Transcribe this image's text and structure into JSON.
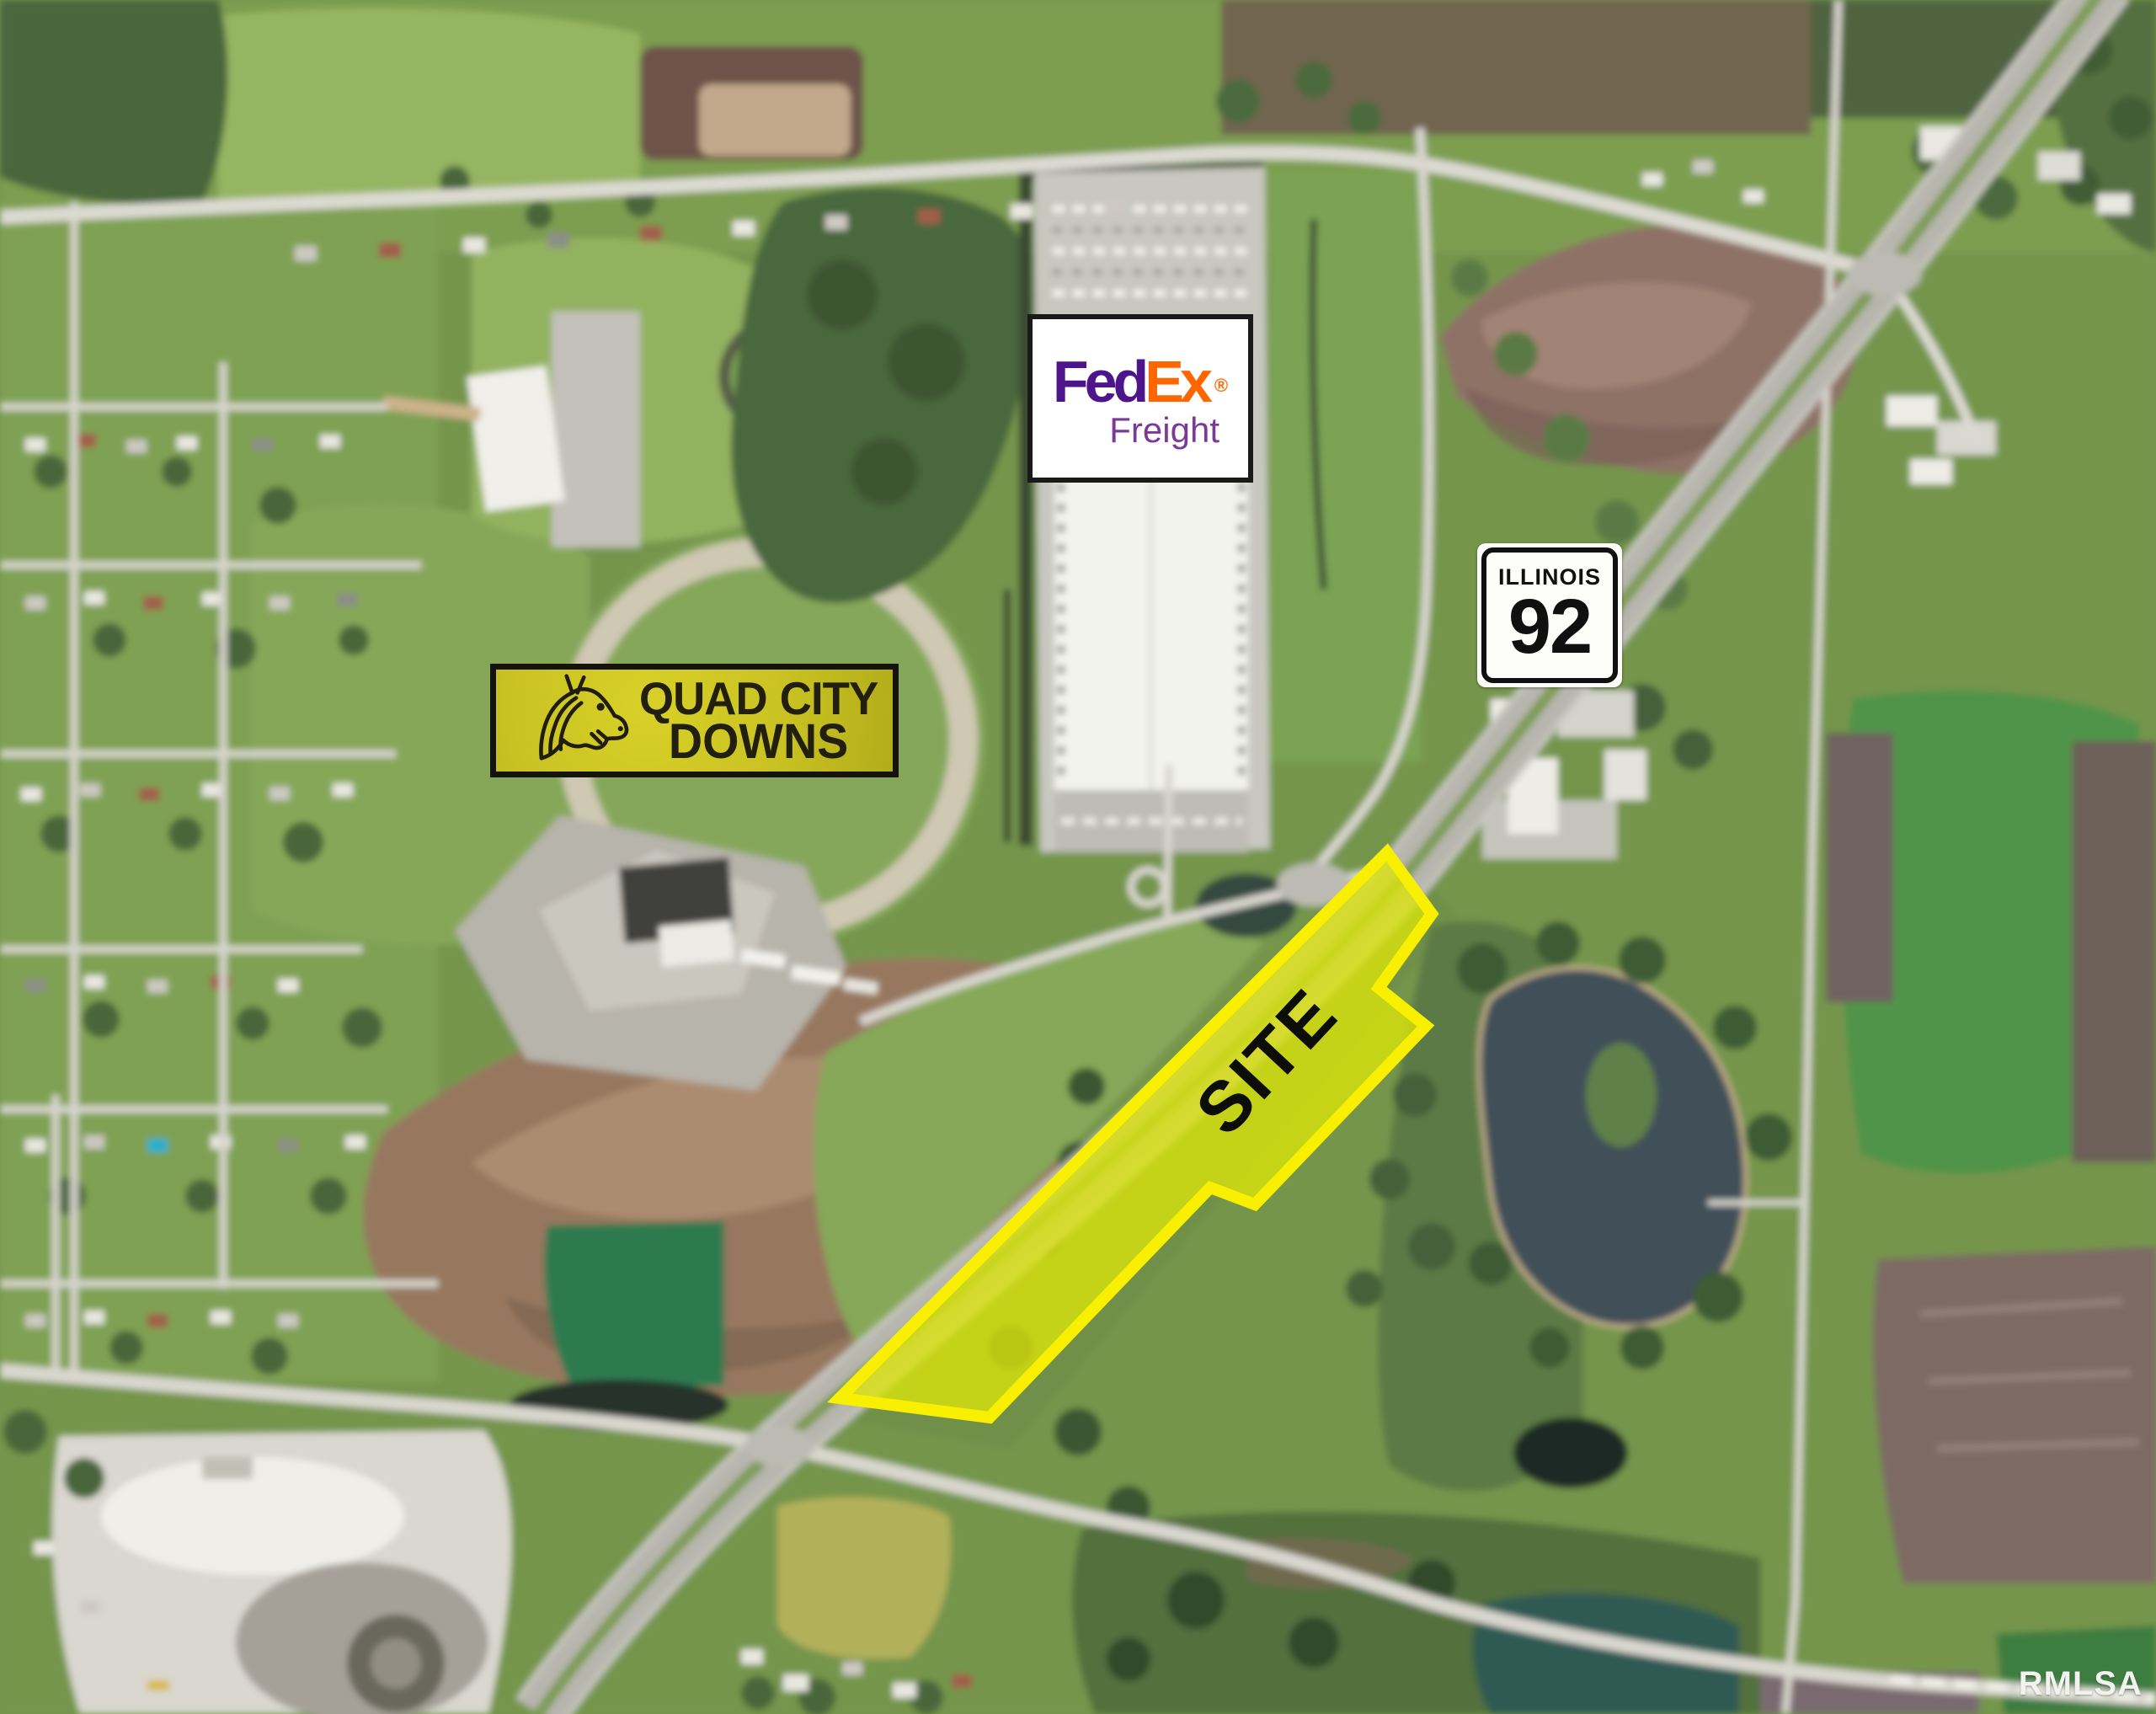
{
  "colors": {
    "fedex-purple": "#4D148C",
    "fedex-orange": "#FF6600",
    "freight-purple": "#7A3A96",
    "sign-yellow": "#C9C222",
    "sign-text": "#221F0E",
    "site-fill": "#DCE60A",
    "site-border": "#F8F000",
    "watermark": "#F2F2EF"
  },
  "overlays": {
    "fedex_sign": {
      "brand_fed": "Fed",
      "brand_ex": "Ex",
      "registered": "®",
      "subtitle": "Freight"
    },
    "route_shield": {
      "state": "ILLINOIS",
      "number": "92"
    },
    "track_sign": {
      "word1": "QUAD",
      "word2": "CITY",
      "line2": "DOWNS"
    },
    "site_marker": {
      "label": "SITE"
    },
    "watermark": {
      "text": "RMLSA"
    }
  }
}
